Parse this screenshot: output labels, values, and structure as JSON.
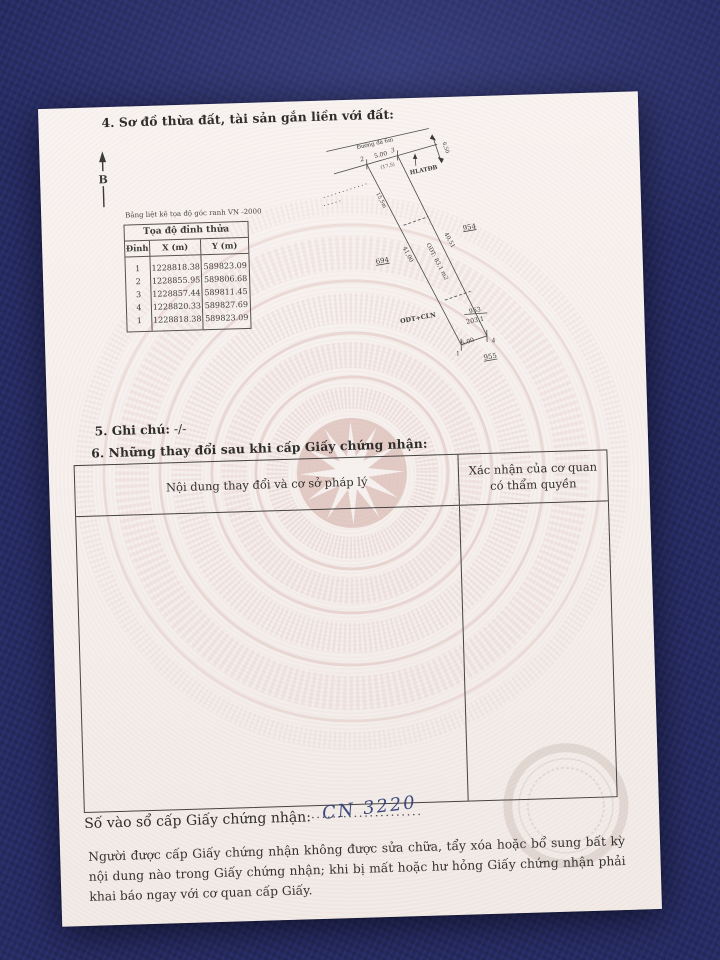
{
  "page": {
    "section4": {
      "title": "4. Sơ đồ thừa đất, tài sản gắn liền với đất:",
      "north_label": "B"
    },
    "coord_table": {
      "caption": "Bảng liệt kê tọa độ góc ranh VN -2000",
      "title": "Tọa độ đỉnh thửa",
      "col_vertex": "Đỉnh",
      "col_x": "X (m)",
      "col_y": "Y (m)",
      "vertex": [
        "1",
        "2",
        "3",
        "4",
        "1"
      ],
      "x": [
        "1228818.38",
        "1228855.95",
        "1228857.44",
        "1228820.33",
        "1228818.38"
      ],
      "y": [
        "589823.09",
        "589806.68",
        "589811.45",
        "589827.69",
        "589823.09"
      ]
    },
    "diagram": {
      "road_label": "Đường đá 6m",
      "pt1": "1",
      "pt2": "2",
      "pt3": "3",
      "pt4": "4",
      "top_dim": "5.00",
      "top_dim_paren": "(17,5)",
      "corridor_label": "HLATĐB",
      "corridor_width": "6,50",
      "seg_upper": "15,5m",
      "len_left": "41,00",
      "len_right": "40,51",
      "area_main": "ODT: 83,1 m2",
      "use_label": "ODT+CLN",
      "parcel_num": "953",
      "parcel_area": "203,1",
      "neighbor_right": "954",
      "neighbor_left": "694",
      "neighbor_bottom": "955",
      "bottom_dim": "5.00"
    },
    "section5": {
      "label": "5. Ghi chú:",
      "value": "-/-"
    },
    "section6": {
      "title": "6. Những thay đổi sau khi cấp Giấy chứng nhận:",
      "col_content": "Nội dung thay đổi và cơ sở pháp lý",
      "col_confirm_line1": "Xác nhận của cơ quan",
      "col_confirm_line2": "có thẩm quyền"
    },
    "footer": {
      "serial_label": "Số vào sổ cấp Giấy chứng nhận:",
      "serial_dots": "..........................................................",
      "serial_value": "CN 3220",
      "warning": "Người được cấp Giấy chứng nhận không được sửa chữa, tẩy xóa hoặc bổ sung bất kỳ nội dung nào trong Giấy chứng nhận; khi bị mất hoặc hư hỏng Giấy chứng nhận phải khai báo ngay với cơ quan cấp Giấy."
    }
  },
  "colors": {
    "background_navy": "#272c66",
    "paper": "#f5efec",
    "ink": "#2f2d2b",
    "watermark_pink": "#cb9c94",
    "handwriting_ink": "#2c3a72"
  }
}
